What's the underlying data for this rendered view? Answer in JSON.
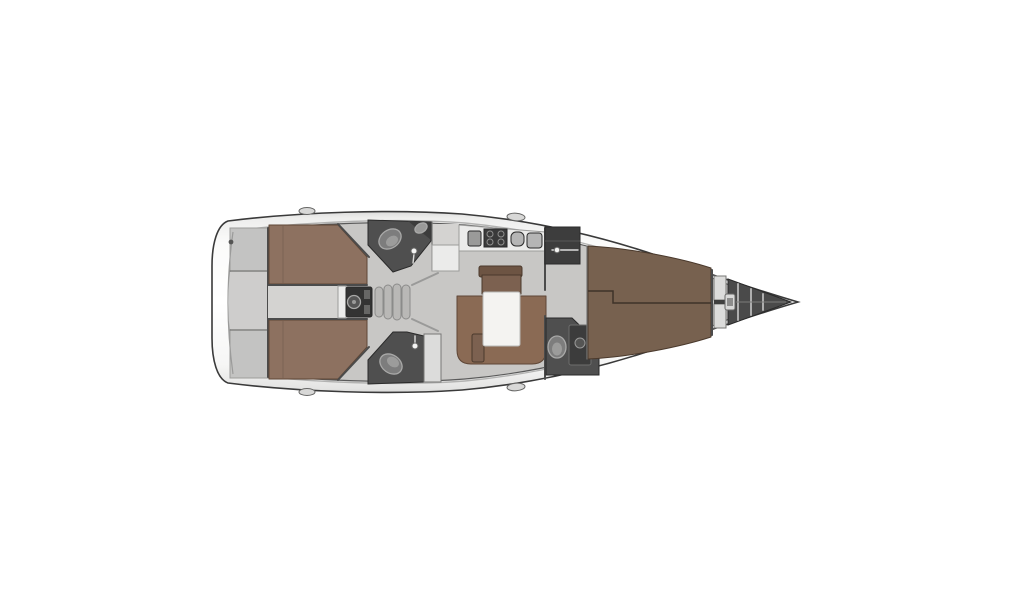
{
  "page": {
    "background": "#ffffff"
  },
  "diagram": {
    "kind": "sailing-yacht-interior-floor-plan",
    "orientation": "bow-right",
    "features": [
      "swim-platform",
      "stern-lockers",
      "aft-cabin-port-berth",
      "aft-cabin-starboard-berth",
      "engine-compartment",
      "companionway-steps",
      "aft-head-port",
      "aft-head-starboard",
      "galley",
      "stove",
      "sinks",
      "saloon-settee",
      "saloon-table",
      "forward-wardrobe",
      "forward-head",
      "shower",
      "forward-cabin-berth",
      "bow-shelves",
      "anchor-locker",
      "mooring-cleats"
    ],
    "colors": {
      "hull_outline": "#3a3a3a",
      "floor": "#c8c7c5",
      "floor_light": "#d4d3d1",
      "berth_aft": "#8d7160",
      "berth_fwd": "#77614f",
      "settee": "#8a6a54",
      "settee_back": "#6d5443",
      "table_leaf": "#7c6150",
      "table_top": "#f4f3f1",
      "head_room": "#4f4f4f",
      "toilet": "#7d7d7d",
      "toilet_seat": "#9c9c9b",
      "stove": "#3a3a3a",
      "sink": "#b5b5b5",
      "wardrobe": "#3d3d3d",
      "engine": "#333333",
      "engine_fan": "#565656",
      "step": "#b9b8b6",
      "stern_locker": "#c3c3c2",
      "stern_recess": "#cecdcc",
      "anchor_locker": "#4a4a4a",
      "rib": "#aeaeae",
      "shelf": "#dcdcdb",
      "cleat": "#d8d8d7",
      "counter": "#ebebea",
      "fixture_dark": "#3c3c3c",
      "fixture_mid": "#9a9a99",
      "white_trim": "#ececeb"
    }
  }
}
